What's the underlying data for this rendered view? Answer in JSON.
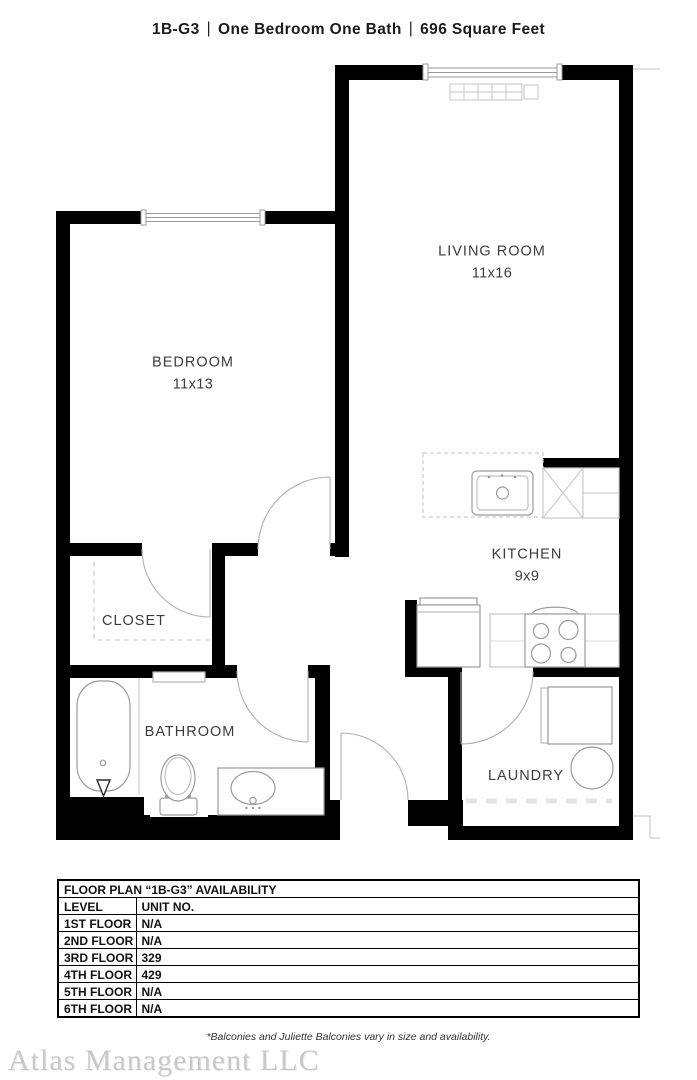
{
  "title": {
    "unit": "1B-G3",
    "divider": "|",
    "layout": "One Bedroom One Bath",
    "area": "696 Square Feet"
  },
  "rooms": {
    "living_room": {
      "name": "LIVING ROOM",
      "dims": "11x16"
    },
    "bedroom": {
      "name": "BEDROOM",
      "dims": "11x13"
    },
    "kitchen": {
      "name": "KITCHEN",
      "dims": "9x9"
    },
    "closet": {
      "name": "CLOSET"
    },
    "bathroom": {
      "name": "BATHROOM"
    },
    "laundry": {
      "name": "LAUNDRY"
    }
  },
  "availability_table": {
    "title": "FLOOR PLAN “1B-G3” AVAILABILITY",
    "columns": [
      "LEVEL",
      "UNIT NO."
    ],
    "rows": [
      [
        "1ST FLOOR",
        "N/A"
      ],
      [
        "2ND FLOOR",
        "N/A"
      ],
      [
        "3RD FLOOR",
        "329"
      ],
      [
        "4TH FLOOR",
        "429"
      ],
      [
        "5TH FLOOR",
        "N/A"
      ],
      [
        "6TH FLOOR",
        "N/A"
      ]
    ]
  },
  "footnote": "*Balconies and Juliette Balconies vary in size and availability.",
  "watermark": "Atlas Management LLC",
  "colors": {
    "wall": "#000000",
    "fixture_outline": "#9b9b9b",
    "light_outline": "#cccccc",
    "text": "#3d3d3d",
    "watermark": "#c9c9c9"
  }
}
